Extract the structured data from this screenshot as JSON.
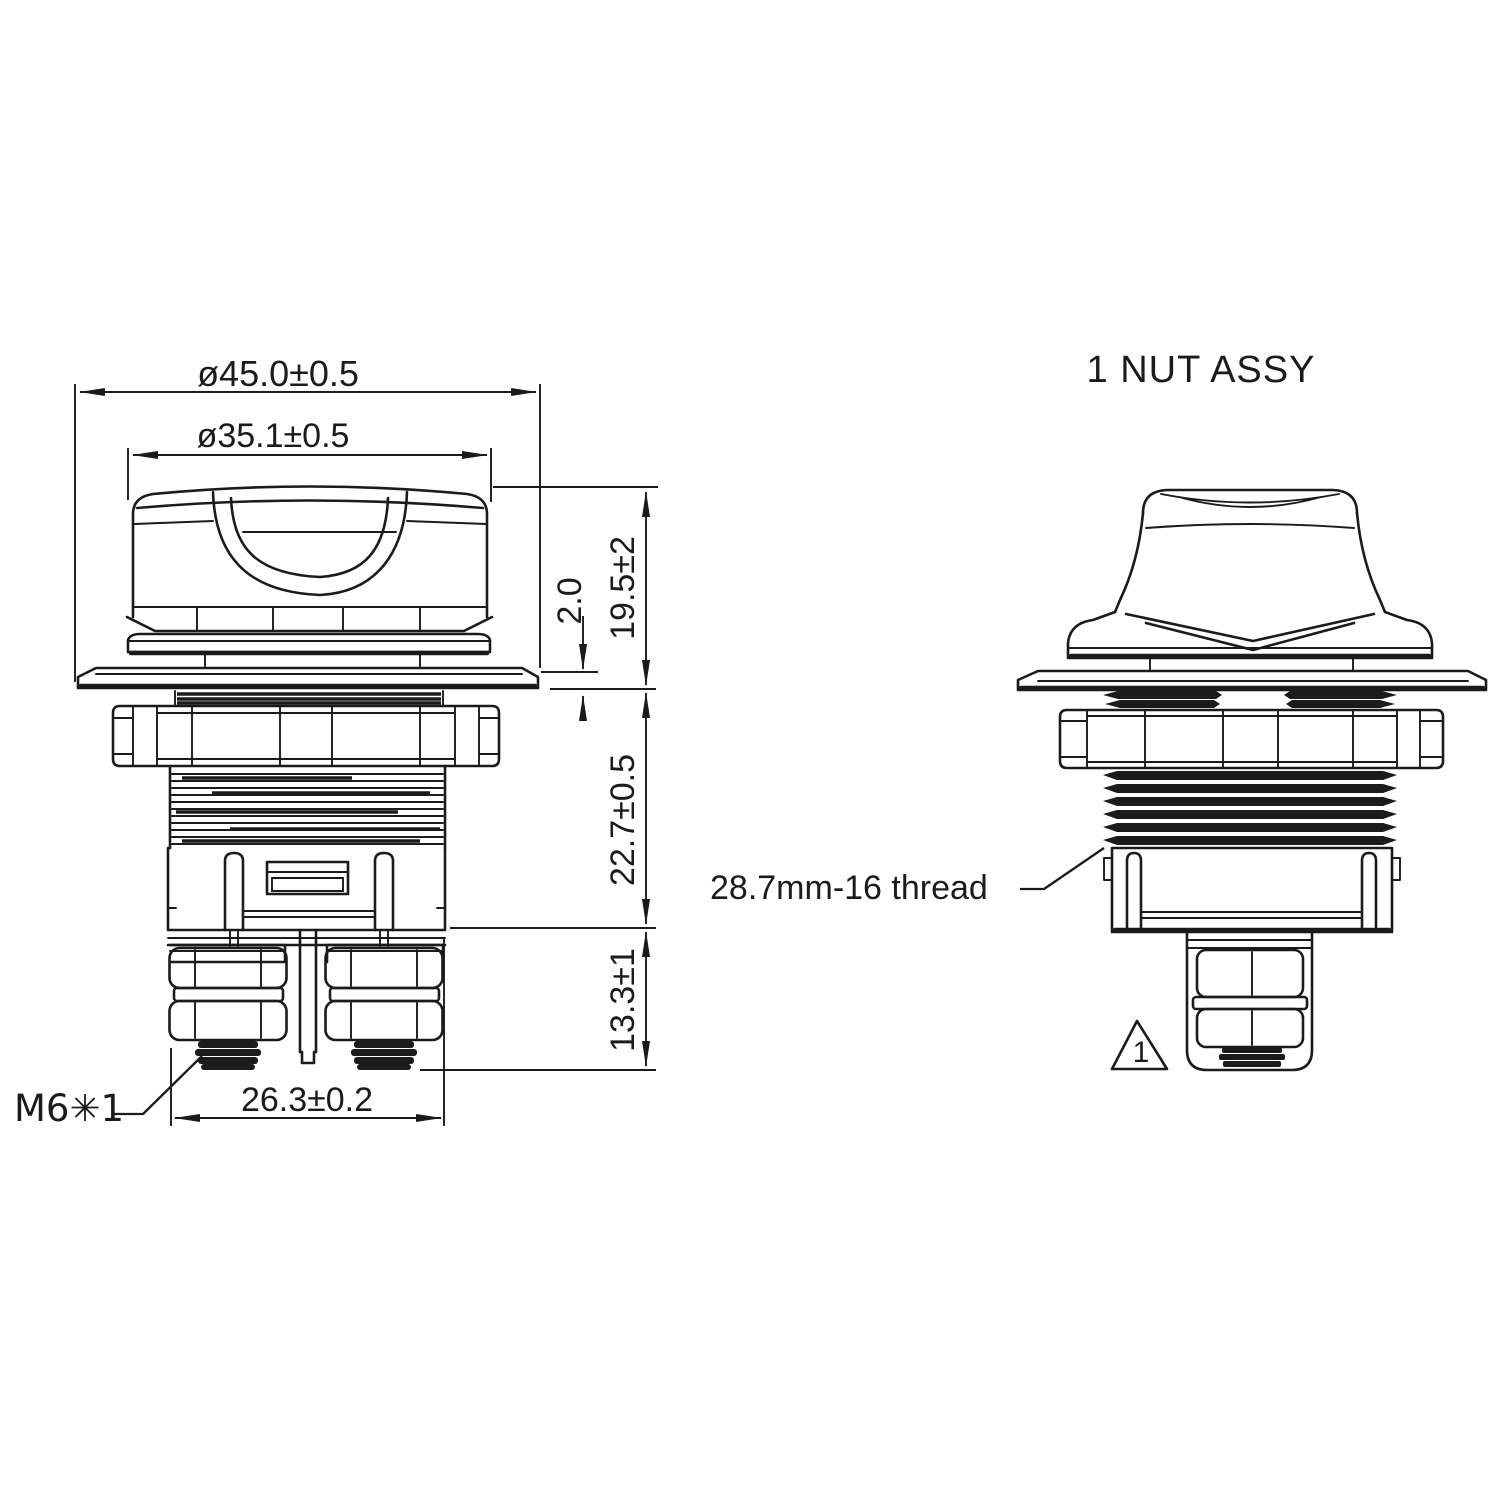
{
  "drawing": {
    "background": "#ffffff",
    "ink": "#1b1b1b",
    "side_view_title": "1 NUT ASSY",
    "dimensions": {
      "plate_diameter": "ø45.0±0.5",
      "knob_diameter": "ø35.1±0.5",
      "knob_height": "19.5±2",
      "plate_thickness": "2.0",
      "body_depth": "22.7±0.5",
      "stud_length": "13.3±1",
      "terminal_width": "26.3±0.2"
    },
    "labels": {
      "stud_thread": "M6✳1",
      "mount_thread": "28.7mm-16 thread",
      "flag_note": "1"
    }
  }
}
